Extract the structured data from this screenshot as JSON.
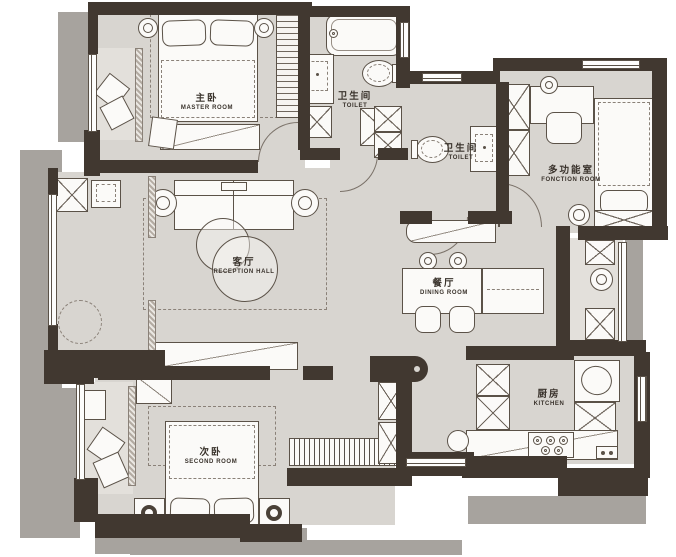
{
  "plan_title": "apartment-floor-plan",
  "colors": {
    "wall": "#413830",
    "floor": "#d8d5d0",
    "shadow": "#a7a39e",
    "line": "#5b5248",
    "paper": "#ffffff"
  },
  "rooms": {
    "master": {
      "zh": "主卧",
      "en": "MASTER ROOM"
    },
    "bath": {
      "zh": "卫生间",
      "en": "TOILET"
    },
    "toilet": {
      "zh": "卫生间",
      "en": "TOILET"
    },
    "function": {
      "zh": "多功能室",
      "en": "FONCTION ROOM"
    },
    "reception": {
      "zh": "客厅",
      "en": "RECEPTION HALL"
    },
    "dining": {
      "zh": "餐厅",
      "en": "DINING ROOM"
    },
    "kitchen": {
      "zh": "厨房",
      "en": "KITCHEN"
    },
    "second": {
      "zh": "次卧",
      "en": "SECOND ROOM"
    }
  }
}
